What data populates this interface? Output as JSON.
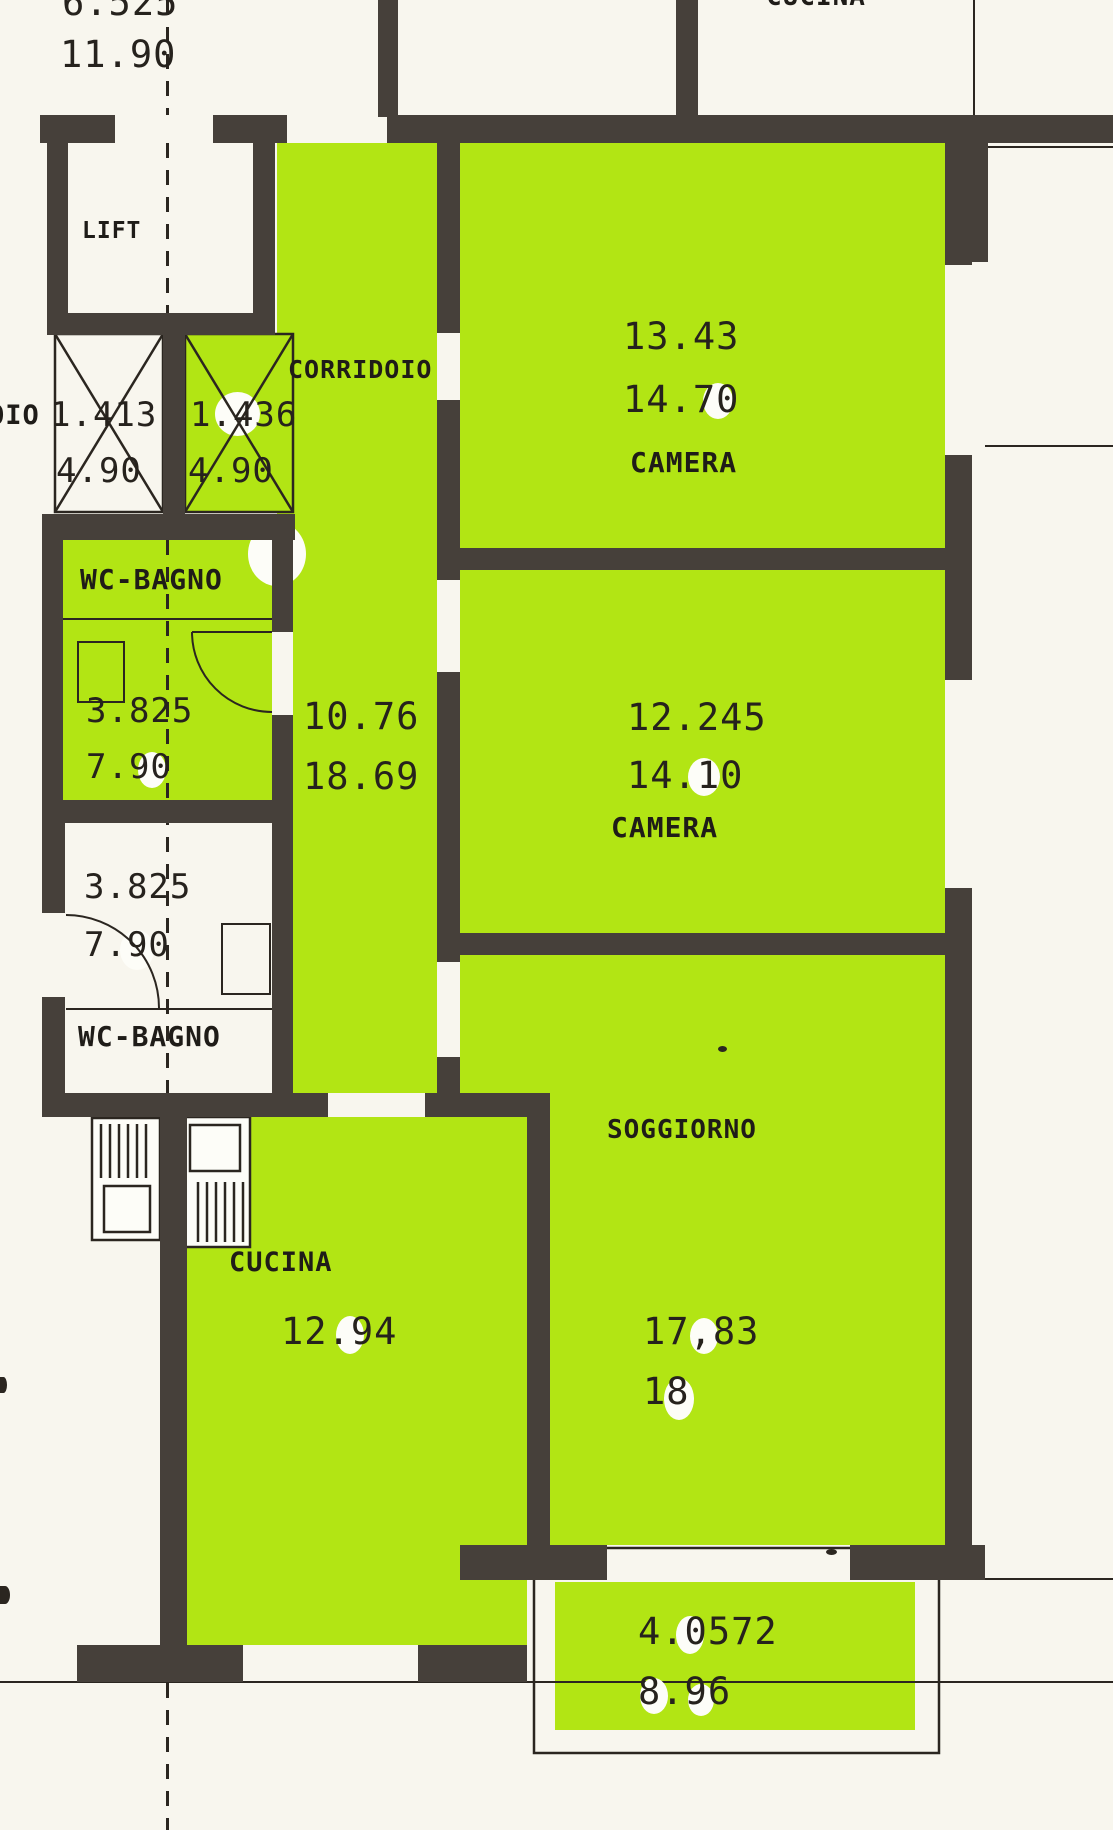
{
  "colors": {
    "highlight": "#b2e514",
    "wall": "#46403a",
    "line": "#2b2620",
    "paper": "#f8f6ee",
    "ink": "#26221d"
  },
  "partials": {
    "top_right_room": "CUCINA",
    "left_edge": "OIO"
  },
  "dimensions_top": {
    "dim1": "6.525",
    "dim2": "11.90"
  },
  "rooms": {
    "lift": {
      "label": "LIFT"
    },
    "shaft_left": {
      "dim1": "1.413",
      "dim2": "4.90"
    },
    "shaft_right": {
      "dim1": "1.436",
      "dim2": "4.90"
    },
    "corridoio": {
      "label": "CORRIDOIO",
      "dim1": "10.76",
      "dim2": "18.69"
    },
    "camera1": {
      "label": "CAMERA",
      "dim1": "13.43",
      "dim2": "14.70"
    },
    "camera2": {
      "label": "CAMERA",
      "dim1": "12.245",
      "dim2": "14.10"
    },
    "wc_bagno_upper": {
      "label": "WC-BAGNO",
      "dim1": "3.825",
      "dim2": "7.90"
    },
    "wc_bagno_lower": {
      "label": "WC-BAGNO",
      "dim1": "3.825",
      "dim2": "7.90"
    },
    "soggiorno": {
      "label": "SOGGIORNO",
      "dim1": "17,83",
      "dim2": "18"
    },
    "cucina": {
      "label": "CUCINA",
      "dim1": "12.94"
    },
    "balcone": {
      "dim1": "4.0572",
      "dim2": "8.96"
    }
  }
}
